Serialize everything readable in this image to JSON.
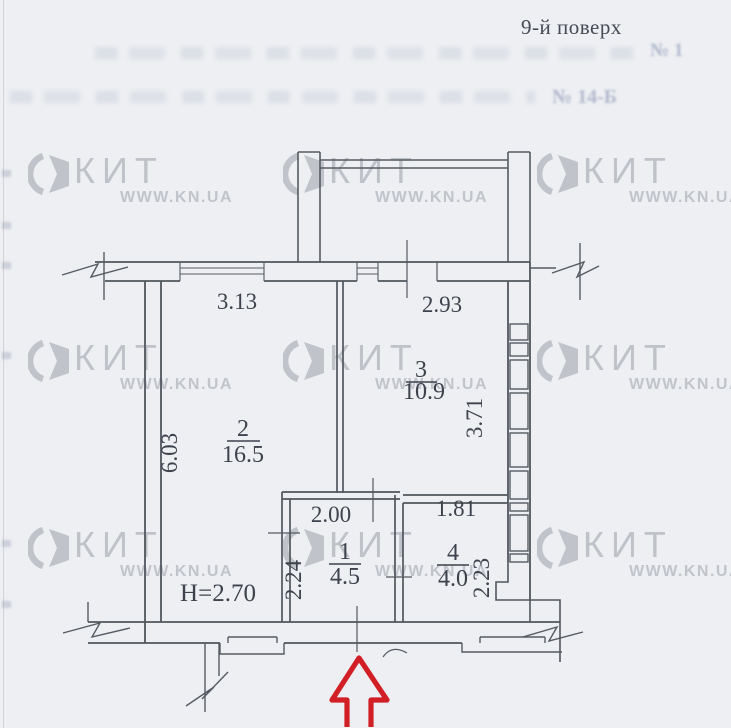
{
  "header": {
    "floor_label": "9-й поверх"
  },
  "watermark": {
    "brand": "КИТ",
    "url": "WWW.KN.UA"
  },
  "ghost": {
    "doc_number": "№ 14-Б",
    "page_ref": "№ 1"
  },
  "plan": {
    "rooms": [
      {
        "number": "2",
        "area": "16.5"
      },
      {
        "number": "3",
        "area": "10.9"
      },
      {
        "number": "1",
        "area": "4.5"
      },
      {
        "number": "4",
        "area": "4.0"
      }
    ],
    "dims": {
      "room2_width": "3.13",
      "room3_width": "2.93",
      "room2_depth": "6.03",
      "room3_depth": "3.71",
      "room1_width": "2.00",
      "room4_width": "1.81",
      "room1_depth": "2.24",
      "room4_depth": "2.23",
      "ceiling_height": "H=2.70"
    }
  }
}
